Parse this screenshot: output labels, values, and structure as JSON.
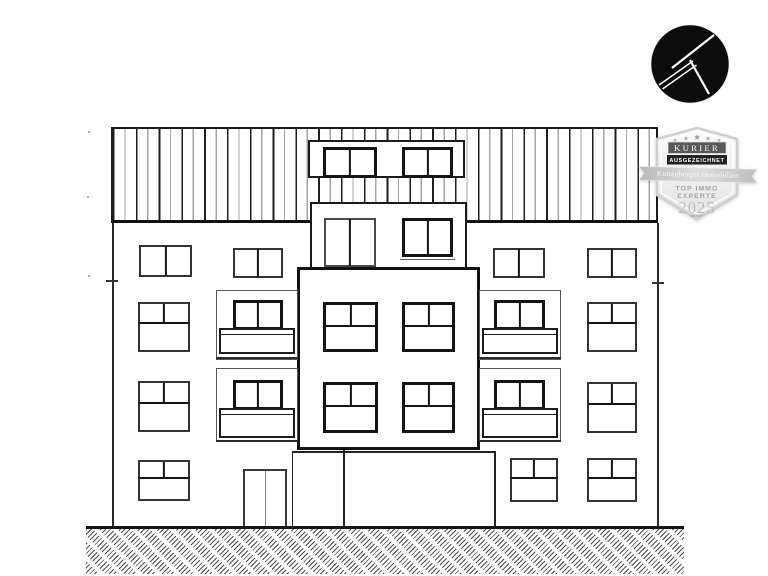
{
  "page": {
    "background": "#ffffff",
    "subject": "Architectural front elevation line drawing of an apartment building"
  },
  "logo": {
    "symbol": "stylized letter K",
    "circle_color": "#0c0c0c",
    "stroke_color": "#ffffff"
  },
  "badge": {
    "star_glyph": "★",
    "publisher": "KURIER",
    "award_label": "AUSGEZEICHNET",
    "company": "Kuttenberger Immobilien",
    "title_line1": "TOP IMMO",
    "title_line2": "EXPERTE",
    "year": "2025",
    "issuer": "IMWF",
    "colors": {
      "shield_fill": "#efefef",
      "shield_border": "#cfcfcf",
      "publisher_box": "#585858",
      "award_box": "#222222",
      "ribbon_fill": "#c9c9c9",
      "muted_text": "#a2a2a2",
      "year_text": "#bcbcbc"
    }
  },
  "drawing": {
    "line_color": "#1a1a1a",
    "storeys_visible": 5,
    "balcony_count": 4,
    "entrance_door_count": 1,
    "roof_zone": "vertical standing-seam band with central dormer",
    "ground_finish": "diagonal hatch strip"
  }
}
